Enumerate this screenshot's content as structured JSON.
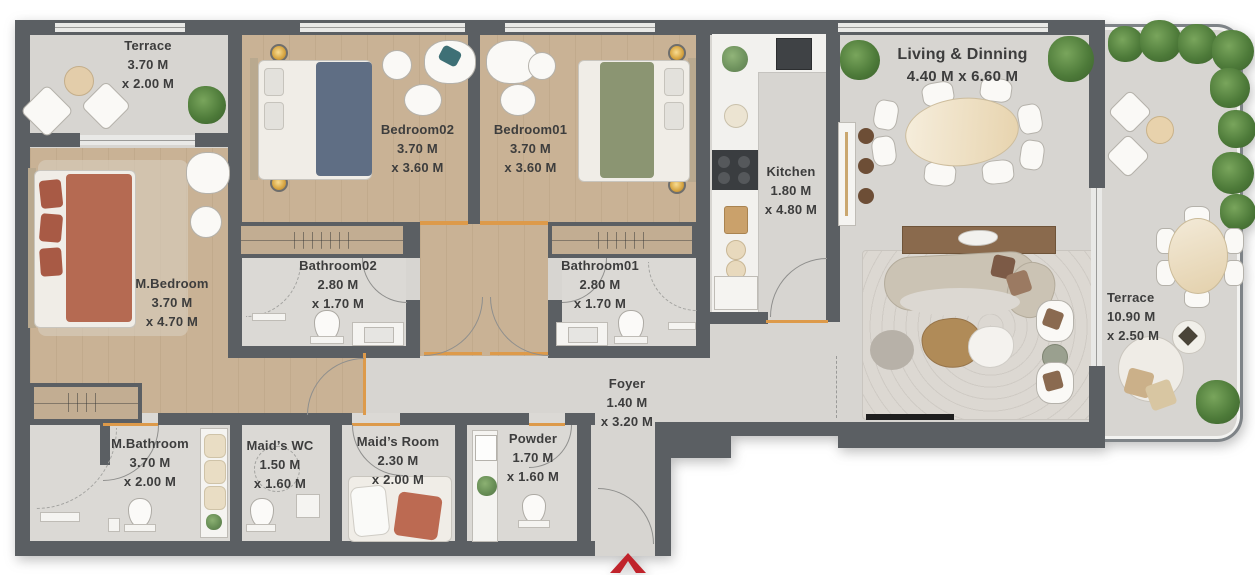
{
  "title": "Apartment floor plan",
  "colors": {
    "wall": "#5b5f63",
    "wood_floor": "#c9b295",
    "stone_floor": "#d7d5d1",
    "door_accent": "#dd9a4a",
    "entry_arrow": "#c0232b",
    "label_text": "#3d3d3d",
    "plant_green": "#4d7a39",
    "master_bed_blanket": "#b56a52",
    "bedroom02_blanket": "#5f6e84",
    "bedroom01_blanket": "#8b9572"
  },
  "entry": {
    "marker": "entry-arrow"
  },
  "rooms": [
    {
      "id": "terrace-left",
      "name": "Terrace",
      "dim1": "3.70 M",
      "dim2": "x 2.00 M"
    },
    {
      "id": "bedroom02",
      "name": "Bedroom02",
      "dim1": "3.70 M",
      "dim2": "x 3.60 M"
    },
    {
      "id": "bedroom01",
      "name": "Bedroom01",
      "dim1": "3.70 M",
      "dim2": "x 3.60 M"
    },
    {
      "id": "kitchen",
      "name": "Kitchen",
      "dim1": "1.80 M",
      "dim2": "x 4.80 M"
    },
    {
      "id": "living-dining",
      "name": "Living & Dinning",
      "dims": "4.40 M x 6.60 M"
    },
    {
      "id": "terrace-right",
      "name": "Terrace",
      "dim1": "10.90 M",
      "dim2": "x 2.50 M"
    },
    {
      "id": "m-bedroom",
      "name": "M.Bedroom",
      "dim1": "3.70 M",
      "dim2": "x 4.70 M"
    },
    {
      "id": "bathroom02",
      "name": "Bathroom02",
      "dim1": "2.80 M",
      "dim2": "x 1.70 M"
    },
    {
      "id": "bathroom01",
      "name": "Bathroom01",
      "dim1": "2.80 M",
      "dim2": "x 1.70 M"
    },
    {
      "id": "foyer",
      "name": "Foyer",
      "dim1": "1.40 M",
      "dim2": "x 3.20 M"
    },
    {
      "id": "m-bathroom",
      "name": "M.Bathroom",
      "dim1": "3.70 M",
      "dim2": "x 2.00 M"
    },
    {
      "id": "maids-wc",
      "name": "Maid’s WC",
      "dim1": "1.50 M",
      "dim2": "x 1.60 M"
    },
    {
      "id": "maids-room",
      "name": "Maid’s Room",
      "dim1": "2.30 M",
      "dim2": "x 2.00 M"
    },
    {
      "id": "powder",
      "name": "Powder",
      "dim1": "1.70 M",
      "dim2": "x 1.60 M"
    }
  ]
}
